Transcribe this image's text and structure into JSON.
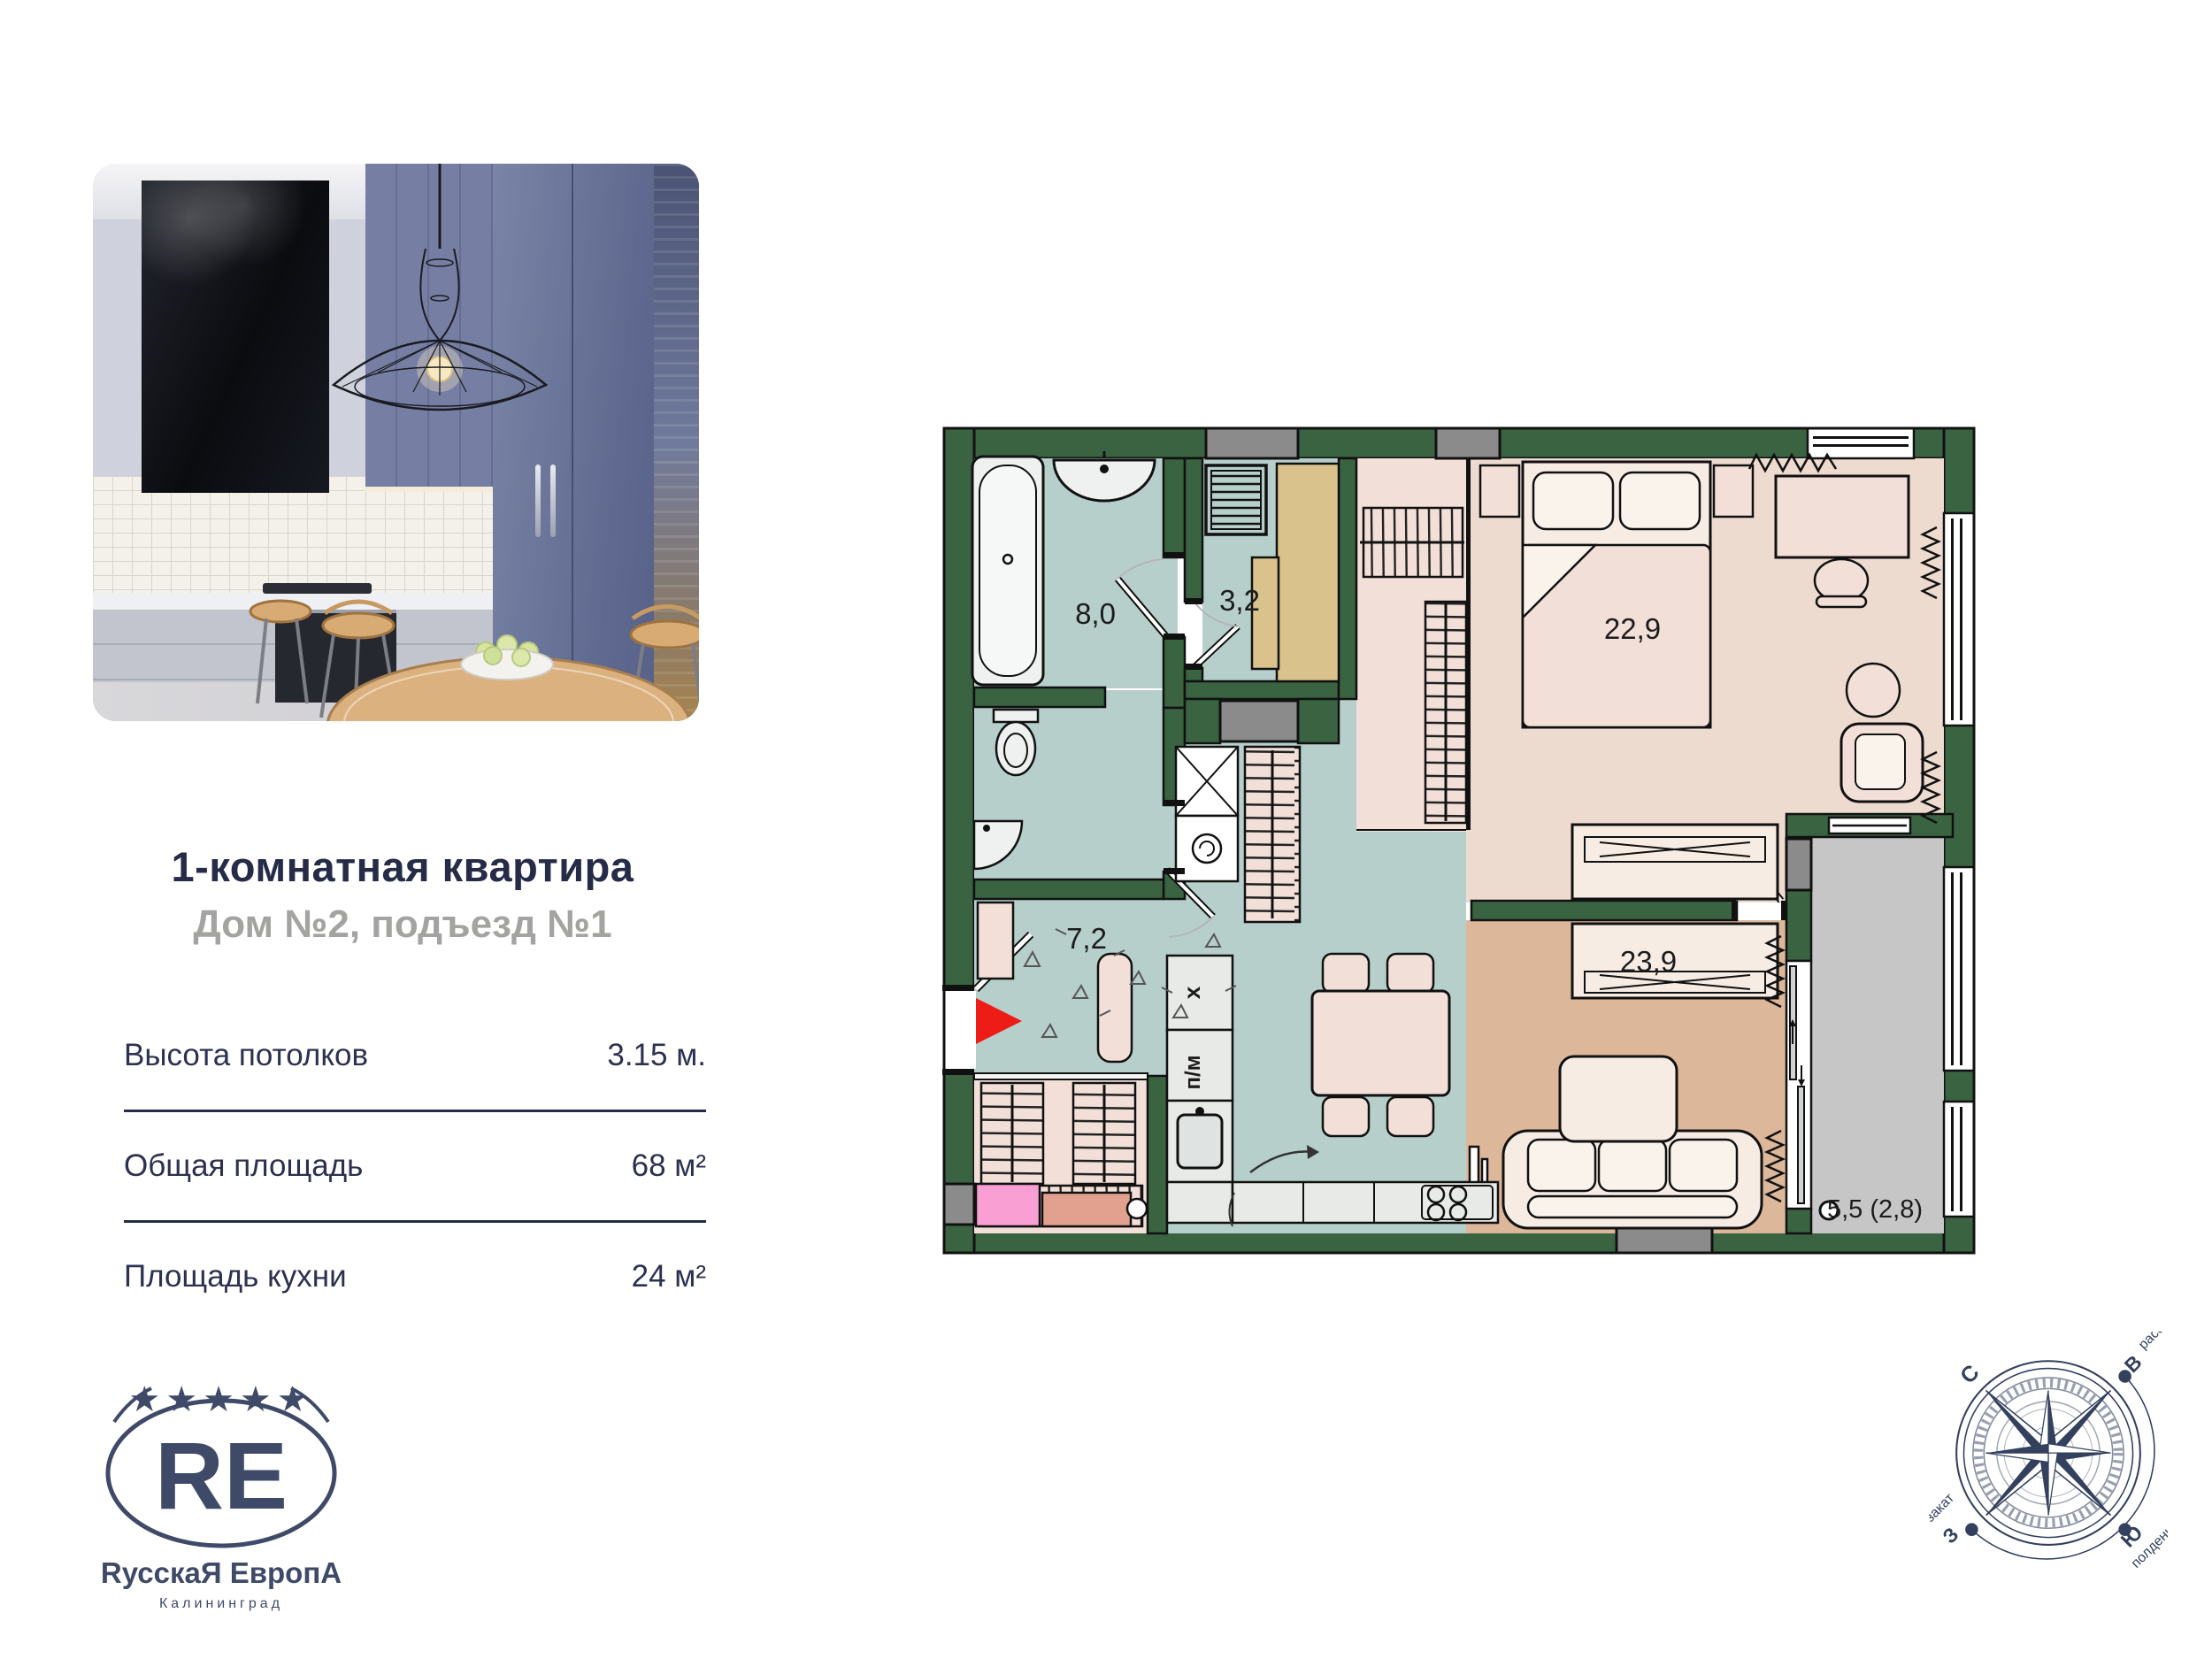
{
  "listing": {
    "title": "1-комнатная квартира",
    "subtitle": "Дом №2, подъезд №1",
    "specs": [
      {
        "label": "Высота потолков",
        "value": "3.15 м."
      },
      {
        "label": "Общая площадь",
        "value": "68 м²"
      },
      {
        "label": "Площадь кухни",
        "value": "24 м²"
      }
    ]
  },
  "logo": {
    "stars": "★★★★★",
    "monogram": "RE",
    "company": "RусскаЯ ЕвропА",
    "city": "Калининград"
  },
  "floorplan": {
    "rooms": [
      {
        "name": "bathroom",
        "area": "8,0"
      },
      {
        "name": "storage",
        "area": "3,2"
      },
      {
        "name": "bedroom",
        "area": "22,9"
      },
      {
        "name": "hallway",
        "area": "7,2"
      },
      {
        "name": "kitchen-living-room",
        "area": "23,9"
      },
      {
        "name": "balcony",
        "area": "5,5 (2,8)"
      }
    ],
    "appliances": {
      "fridge": "х",
      "dishwasher": "п/м"
    },
    "colors": {
      "wall": "#3a6342",
      "shaft": "#8b8b8b",
      "wet_floor": "#b7cfcb",
      "room_floor": "#eedbd0",
      "wardrobe_floor": "#f2e0d8",
      "closet_tan": "#d9c28b",
      "living_floor": "#dcb79a",
      "balcony_floor": "#c6c6c6",
      "entry_marker": "#ee1c16"
    }
  },
  "compass": {
    "north": "С",
    "east": "В",
    "south": "Ю",
    "west": "З",
    "dawn": "рассвет",
    "noon": "полдень",
    "sunset": "закат"
  }
}
